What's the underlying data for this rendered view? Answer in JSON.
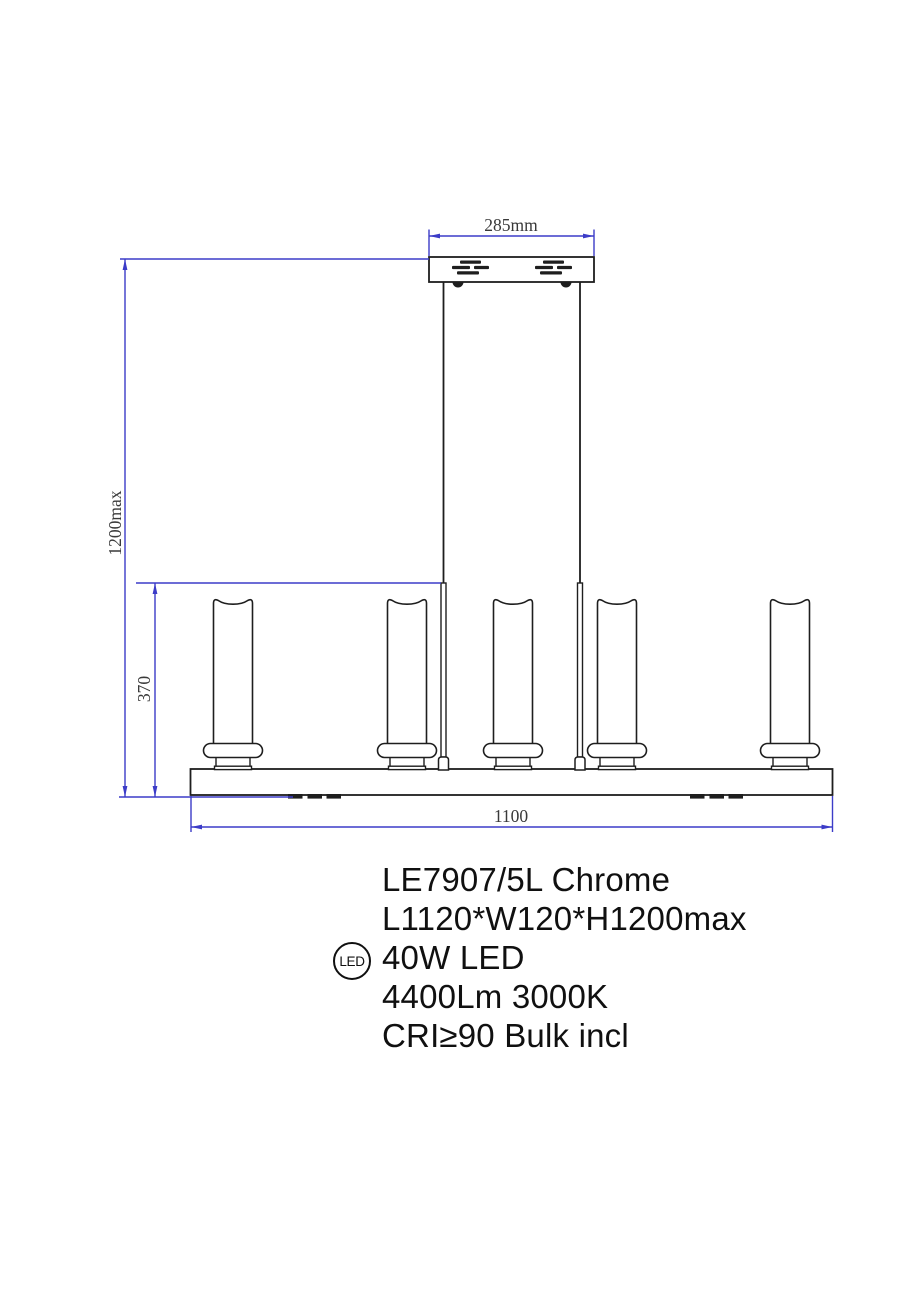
{
  "drawing": {
    "dimensions": {
      "canopy_width": "285mm",
      "overall_height": "1200max",
      "shade_height": "370",
      "fixture_length": "1100"
    },
    "colors": {
      "dimension_line": "#3c3cc8",
      "outline": "#1e1e1e"
    },
    "lamp_count": 5
  },
  "specs": {
    "model": "LE7907/5L Chrome",
    "size": "L1120*W120*H1200max",
    "power": "40W LED",
    "luminous": "4400Lm 3000K",
    "cri": "CRI≥90 Bulk incl",
    "led_badge": "LED"
  }
}
